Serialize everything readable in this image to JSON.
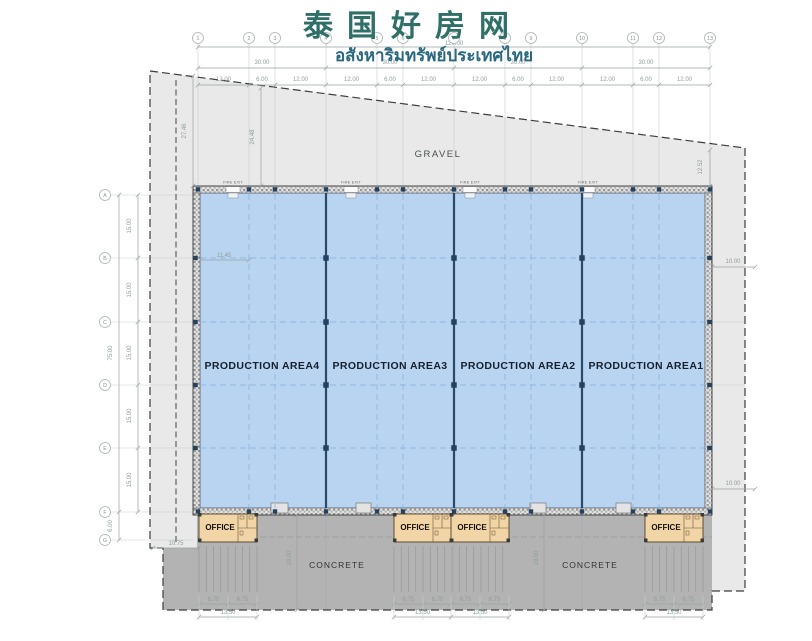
{
  "header": {
    "title": "泰国好房网",
    "subtitle": "อสังหาริมทรัพย์ประเทศไทย"
  },
  "grid": {
    "cols": [
      "1",
      "2",
      "3",
      "4",
      "5",
      "6",
      "7",
      "8",
      "9",
      "10",
      "11",
      "12",
      "13"
    ],
    "rows": [
      "A",
      "B",
      "C",
      "D",
      "E",
      "F",
      "G"
    ]
  },
  "labels": {
    "gravel": "GRAVEL",
    "concrete": "CONCRETE",
    "office": "OFFICE",
    "fire_exit": "FIRE EXIT",
    "production_areas": [
      "PRODUCTION AREA4",
      "PRODUCTION AREA3",
      "PRODUCTION AREA2",
      "PRODUCTION AREA1"
    ]
  },
  "dimensions": {
    "overall_width": "120.00",
    "bay_width": "30.00",
    "sub_bays": [
      "12.00",
      "6.00",
      "12.00"
    ],
    "overall_depth": "75.00",
    "row_spacing": "15.00",
    "row_fg": "6.00",
    "left_inset": "11.45",
    "boundary_left": "27.46",
    "boundary_mid": "24.48",
    "boundary_right": "12.52",
    "side_clearance": "10.00",
    "rear_clearance": "10.75",
    "apron_depth": "19.00",
    "office_half": "6.75",
    "office_width": "13.50"
  },
  "colors": {
    "title": "#2e6f68",
    "subtitle": "#29687f",
    "production_fill": "#b8d4f0",
    "production_grid": "#85aedd",
    "divider_wall": "#2b4964",
    "office_fill": "#f1d5a6",
    "site_fill": "#e8e9e8",
    "concrete_fill": "#b2b3b2",
    "dimension_text": "#8f9d9d"
  }
}
